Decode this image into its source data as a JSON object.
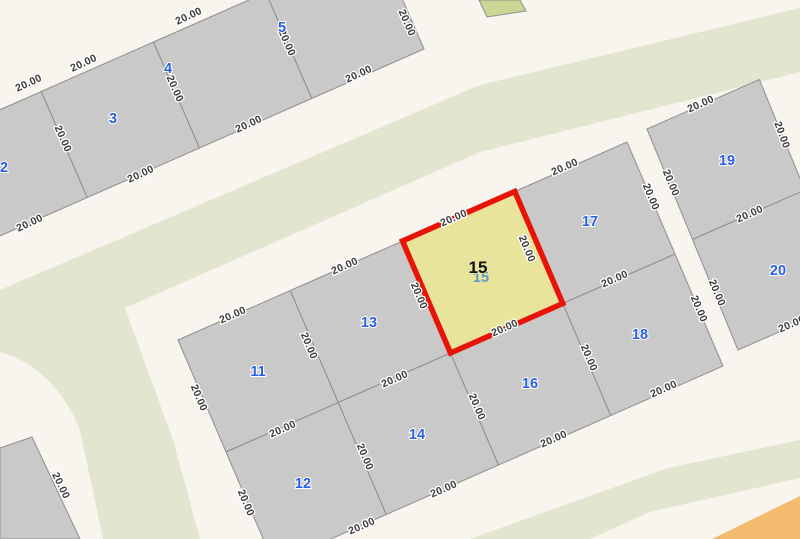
{
  "map": {
    "title": "cadastral-parcel-map",
    "colors": {
      "background": "#f8f5ef",
      "road": "#f8f5ef",
      "green_area": "#e2e5d0",
      "orange_area": "#f2bb70",
      "parcel_fill": "#c9c9c9",
      "parcel_stroke": "#8f8f8f",
      "small_parcel_fill": "#cbd694",
      "selected_fill": "#e9e49c",
      "selected_border": "#e81408",
      "number_color": "#2b5fe3",
      "edge_label_color": "#3a3a3a"
    },
    "selected_parcel": {
      "id": "15",
      "side_dimension": "20.00"
    },
    "areas": [
      {
        "name": "green-median-band",
        "kind": "green",
        "path": "M 0,290 L 480,85 L 800,8 L 800,72 L 480,152 L 125,308 L 173,440 L 200,539 L 103,539 L 80,430 Q 55,368 0,352 Z"
      },
      {
        "name": "green-south-strip",
        "kind": "green",
        "path": "M 470,539 L 668,468 L 800,440 L 800,478 L 650,512 L 590,539 Z"
      },
      {
        "name": "orange-corner-strip",
        "kind": "orange",
        "path": "M 712,539 L 800,496 L 800,539 Z"
      }
    ],
    "small_parcel": {
      "name": "parcel-16m",
      "points": "479,0 487,17 526,11 520,0",
      "label": "16.00",
      "label_x": 506,
      "label_y": 10,
      "label_rot": -20
    },
    "parcels": [
      {
        "id": "2",
        "points": "-71,141 41.3,91.5 87.3,197.5 -25,247",
        "nx": 4,
        "ny": 172
      },
      {
        "id": "3",
        "points": "41.3,91.5 153.5,42 199.5,148 87.3,197.5",
        "nx": 113,
        "ny": 123
      },
      {
        "id": "4",
        "points": "153.5,42 265.8,-7.5 311.8,98.5 199.5,148",
        "nx": 168,
        "ny": 73
      },
      {
        "id": "5",
        "points": "265.8,-7.5 378,-57 424,49 311.8,98.5",
        "nx": 282,
        "ny": 32
      },
      {
        "id": "11",
        "points": "178,340 290.3,290.5 338.3,402.5 226,452",
        "nx": 258,
        "ny": 376
      },
      {
        "id": "13",
        "points": "290.3,290.5 402.5,241 450.5,353 338.3,402.5",
        "nx": 369,
        "ny": 327
      },
      {
        "id": "17",
        "points": "514.8,191.5 627,142 675,254 562.8,303.5",
        "nx": 590,
        "ny": 226
      },
      {
        "id": "12",
        "points": "226,452 338.3,402.5 386.3,514.5 274,564",
        "nx": 303,
        "ny": 488
      },
      {
        "id": "14",
        "points": "338.3,402.5 450.5,353 498.5,465 386.3,514.5",
        "nx": 417,
        "ny": 439
      },
      {
        "id": "16",
        "points": "450.5,353 562.8,303.5 610.8,415.5 498.5,465",
        "nx": 530,
        "ny": 388
      },
      {
        "id": "18",
        "points": "562.8,303.5 675,254 723,366 610.8,415.5",
        "nx": 640,
        "ny": 339
      },
      {
        "id": "19",
        "points": "647,129 759.3,79.5 804.8,190 692.5,239.5",
        "nx": 727,
        "ny": 165
      },
      {
        "id": "20",
        "points": "692.5,239.5 804.8,190 850,300.5 738,350",
        "nx": 778,
        "ny": 275
      },
      {
        "id": "sw-corner",
        "points": "0,448 32,437 80,539 0,539",
        "nx": -50,
        "ny": -50
      }
    ],
    "selected": {
      "id": "15",
      "points": "402.5,241 514.8,191.5 562.8,303.5 450.5,353",
      "nx": 478,
      "ny": 273,
      "ghost_x": 481,
      "ghost_y": 282
    },
    "edge_labels": [
      {
        "t": "20.00",
        "x": 30,
        "y": 86,
        "r": -25
      },
      {
        "t": "20.00",
        "x": 85,
        "y": 66,
        "r": -25
      },
      {
        "t": "20.00",
        "x": 190,
        "y": 19,
        "r": -25
      },
      {
        "t": "20.00",
        "x": 60,
        "y": 140,
        "r": 66
      },
      {
        "t": "20.00",
        "x": 172,
        "y": 90,
        "r": 66
      },
      {
        "t": "20.00",
        "x": 284,
        "y": 44,
        "r": 66
      },
      {
        "t": "20.00",
        "x": 404,
        "y": 24,
        "r": 66
      },
      {
        "t": "20.00",
        "x": 31,
        "y": 226,
        "r": -25
      },
      {
        "t": "20.00",
        "x": 142,
        "y": 177,
        "r": -25
      },
      {
        "t": "20.00",
        "x": 250,
        "y": 127,
        "r": -25
      },
      {
        "t": "20.00",
        "x": 360,
        "y": 77,
        "r": -25
      },
      {
        "t": "20.00",
        "x": 234,
        "y": 318,
        "r": -24
      },
      {
        "t": "20.00",
        "x": 346,
        "y": 269,
        "r": -24
      },
      {
        "t": "20.00",
        "x": 455,
        "y": 221,
        "r": -24
      },
      {
        "t": "20.00",
        "x": 566,
        "y": 170,
        "r": -24
      },
      {
        "t": "20.00",
        "x": 196,
        "y": 399,
        "r": 67
      },
      {
        "t": "20.00",
        "x": 243,
        "y": 504,
        "r": 67
      },
      {
        "t": "20.00",
        "x": 306,
        "y": 347,
        "r": 67
      },
      {
        "t": "20.00",
        "x": 416,
        "y": 297,
        "r": 67
      },
      {
        "t": "20.00",
        "x": 524,
        "y": 250,
        "r": 67
      },
      {
        "t": "20.00",
        "x": 362,
        "y": 458,
        "r": 67
      },
      {
        "t": "20.00",
        "x": 474,
        "y": 408,
        "r": 67
      },
      {
        "t": "20.00",
        "x": 586,
        "y": 359,
        "r": 67
      },
      {
        "t": "20.00",
        "x": 284,
        "y": 432,
        "r": -24
      },
      {
        "t": "20.00",
        "x": 396,
        "y": 382,
        "r": -24
      },
      {
        "t": "20.00",
        "x": 506,
        "y": 331,
        "r": -24
      },
      {
        "t": "20.00",
        "x": 616,
        "y": 282,
        "r": -24
      },
      {
        "t": "20.00",
        "x": 363,
        "y": 529,
        "r": -24
      },
      {
        "t": "20.00",
        "x": 445,
        "y": 492,
        "r": -24
      },
      {
        "t": "20.00",
        "x": 555,
        "y": 442,
        "r": -24
      },
      {
        "t": "20.00",
        "x": 665,
        "y": 392,
        "r": -24
      },
      {
        "t": "20.00",
        "x": 648,
        "y": 198,
        "r": 67
      },
      {
        "t": "20.00",
        "x": 696,
        "y": 310,
        "r": 67
      },
      {
        "t": "20.00",
        "x": 702,
        "y": 107,
        "r": -24
      },
      {
        "t": "20.00",
        "x": 779,
        "y": 136,
        "r": 70
      },
      {
        "t": "20.00",
        "x": 668,
        "y": 184,
        "r": 67
      },
      {
        "t": "20.00",
        "x": 751,
        "y": 217,
        "r": -24
      },
      {
        "t": "20.00",
        "x": 714,
        "y": 294,
        "r": 67
      },
      {
        "t": "20.00",
        "x": 793,
        "y": 327,
        "r": -24
      },
      {
        "t": "20.00",
        "x": 58,
        "y": 487,
        "r": 64
      }
    ]
  }
}
